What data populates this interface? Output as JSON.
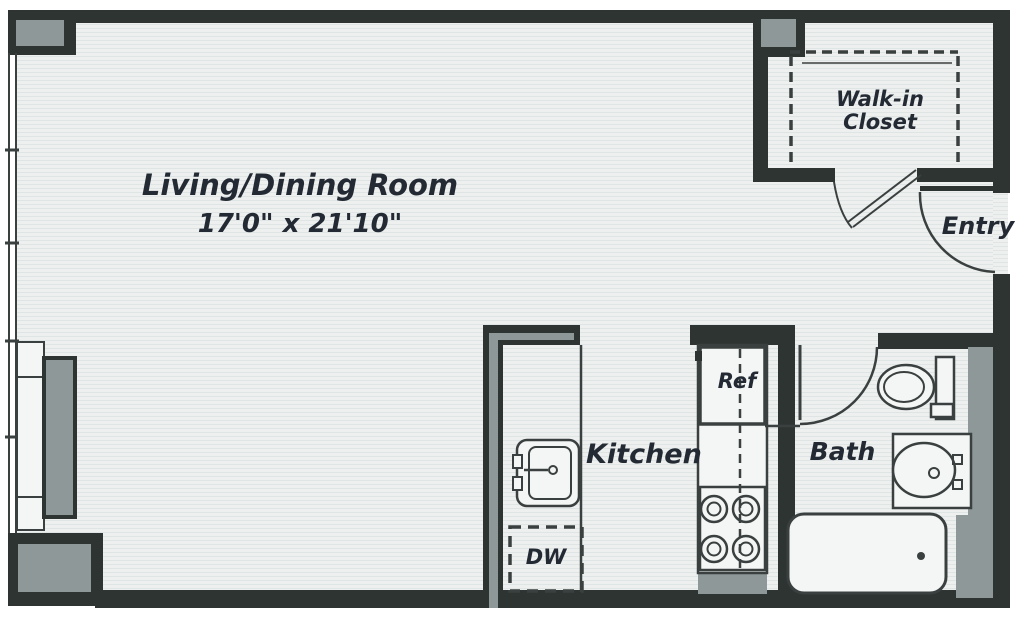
{
  "title": "Studio apartment floor plan",
  "colors": {
    "wall": "#2e3432",
    "accent_gray": "#8e9898",
    "floor": "#eef0ef",
    "floor_stripe": "#dfe4e5",
    "floor_light": "#f4f6f5",
    "line": "#3a403f",
    "text": "#232a33"
  },
  "rooms": {
    "living": {
      "name": "Living/Dining Room",
      "dimensions": "17'0\" x 21'10\""
    },
    "closet": {
      "name": "Walk-in Closet"
    },
    "entry": {
      "name": "Entry"
    },
    "kitchen": {
      "name": "Kitchen"
    },
    "bath": {
      "name": "Bath"
    }
  },
  "appliances": {
    "refrigerator": "Ref",
    "dishwasher": "DW"
  }
}
